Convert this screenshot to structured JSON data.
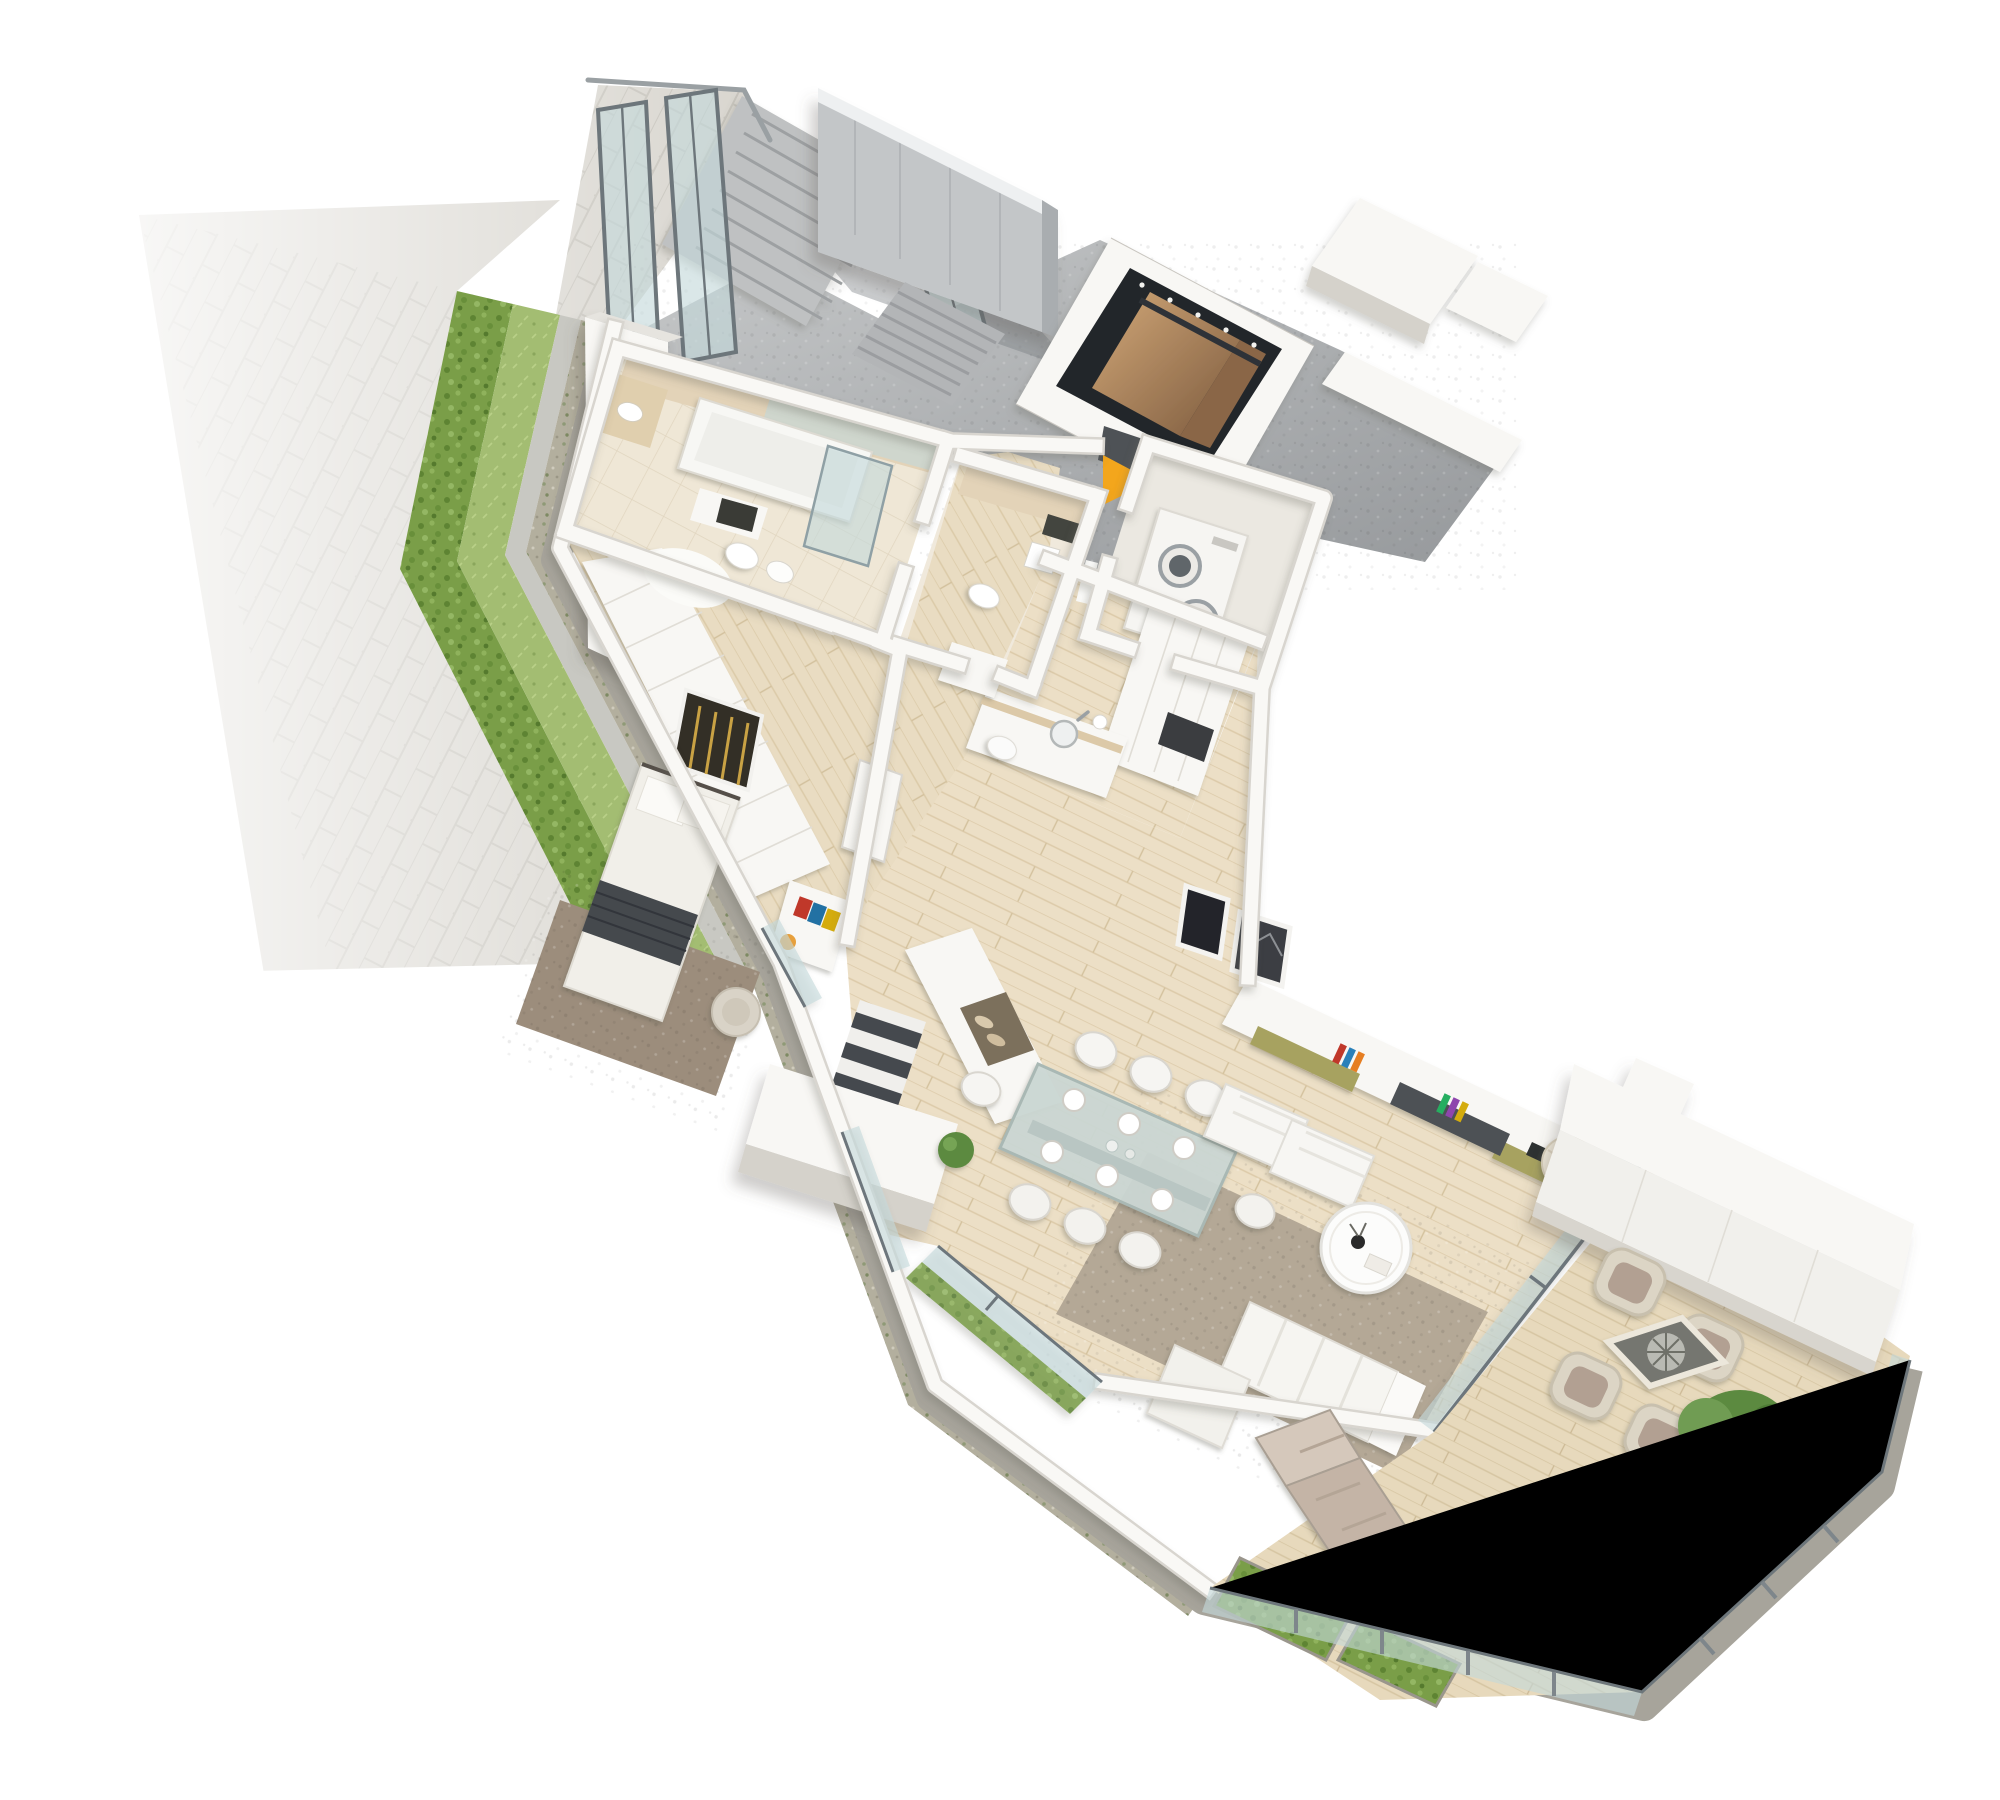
{
  "meta": {
    "description": "3D isometric cutaway floor-plan rendering of a ground-floor apartment: street pavement and hedge strips at upper left, sunken entrance court with exterior stair and elevator, amber entrance-direction arrow, master bedroom with wardrobe, two bathrooms, laundry room, open kitchen, living-dining area, and a large wooden terrace with outdoor furniture and a tree at lower right.",
    "canvas": {
      "width": 2000,
      "height": 1800
    },
    "style": "architectural 3D visualization, white background"
  },
  "colors": {
    "background": "#ffffff",
    "arrow": "#F3A61C",
    "pavement": "#d7d4cd",
    "hedge": "#7a9e48",
    "grass": "#a3bd72",
    "curb": "#c8c8c2",
    "gravel": "#b3af9e",
    "court_concrete": "#aaacae",
    "concrete_wall": "#c3c6c8",
    "elevator_shaft": "#24282c",
    "elevator_copper": "#b48a63",
    "wall_white": "#f8f7f4",
    "wall_shade": "#d5d2cb",
    "wood_floor": "#e9dcc2",
    "deck": "#e7d9bc",
    "bath_tile": "#efe7d6",
    "bath_wall_tile": "#e3d3b8",
    "glass": "#c3d8da",
    "glass_frame": "#6d767b",
    "rug_living": "#b4a896",
    "rug_bedroom": "#9c8d7c",
    "bed_throw": "#45494e",
    "olive_accent": "#a7a261",
    "wicker": "#dcd5c5",
    "outdoor_cushion": "#b2a092",
    "tree_green": "#5b8a40",
    "plinth": "#a7a49b"
  },
  "marker": {
    "entrance_arrow": {
      "shape": "right-pointing triangle",
      "color": "#F3A61C"
    }
  },
  "counts": {
    "dining_chairs": 8,
    "dining_plates": 6,
    "lounge_chairs": 2,
    "terrace_armchairs": 4,
    "sun_loungers": 1,
    "washer_dryer_units": 2,
    "framed_pictures_living": 2,
    "bedrooms": 1,
    "bathrooms": 2,
    "elevators": 1,
    "trees_on_terrace": 1
  },
  "areas": [
    {
      "name": "sidewalk-pavement"
    },
    {
      "name": "hedge-strip"
    },
    {
      "name": "grass-strip"
    },
    {
      "name": "concrete-curb"
    },
    {
      "name": "gravel-planting-strip"
    },
    {
      "name": "entrance-court"
    },
    {
      "name": "exterior-stair"
    },
    {
      "name": "communal-stair"
    },
    {
      "name": "elevator"
    },
    {
      "name": "master-bathroom"
    },
    {
      "name": "guest-wc"
    },
    {
      "name": "laundry-room"
    },
    {
      "name": "hallway"
    },
    {
      "name": "master-bedroom"
    },
    {
      "name": "internal-stair"
    },
    {
      "name": "kitchen"
    },
    {
      "name": "living-dining-room"
    },
    {
      "name": "terrace"
    },
    {
      "name": "outdoor-wardrobe-wall"
    }
  ]
}
